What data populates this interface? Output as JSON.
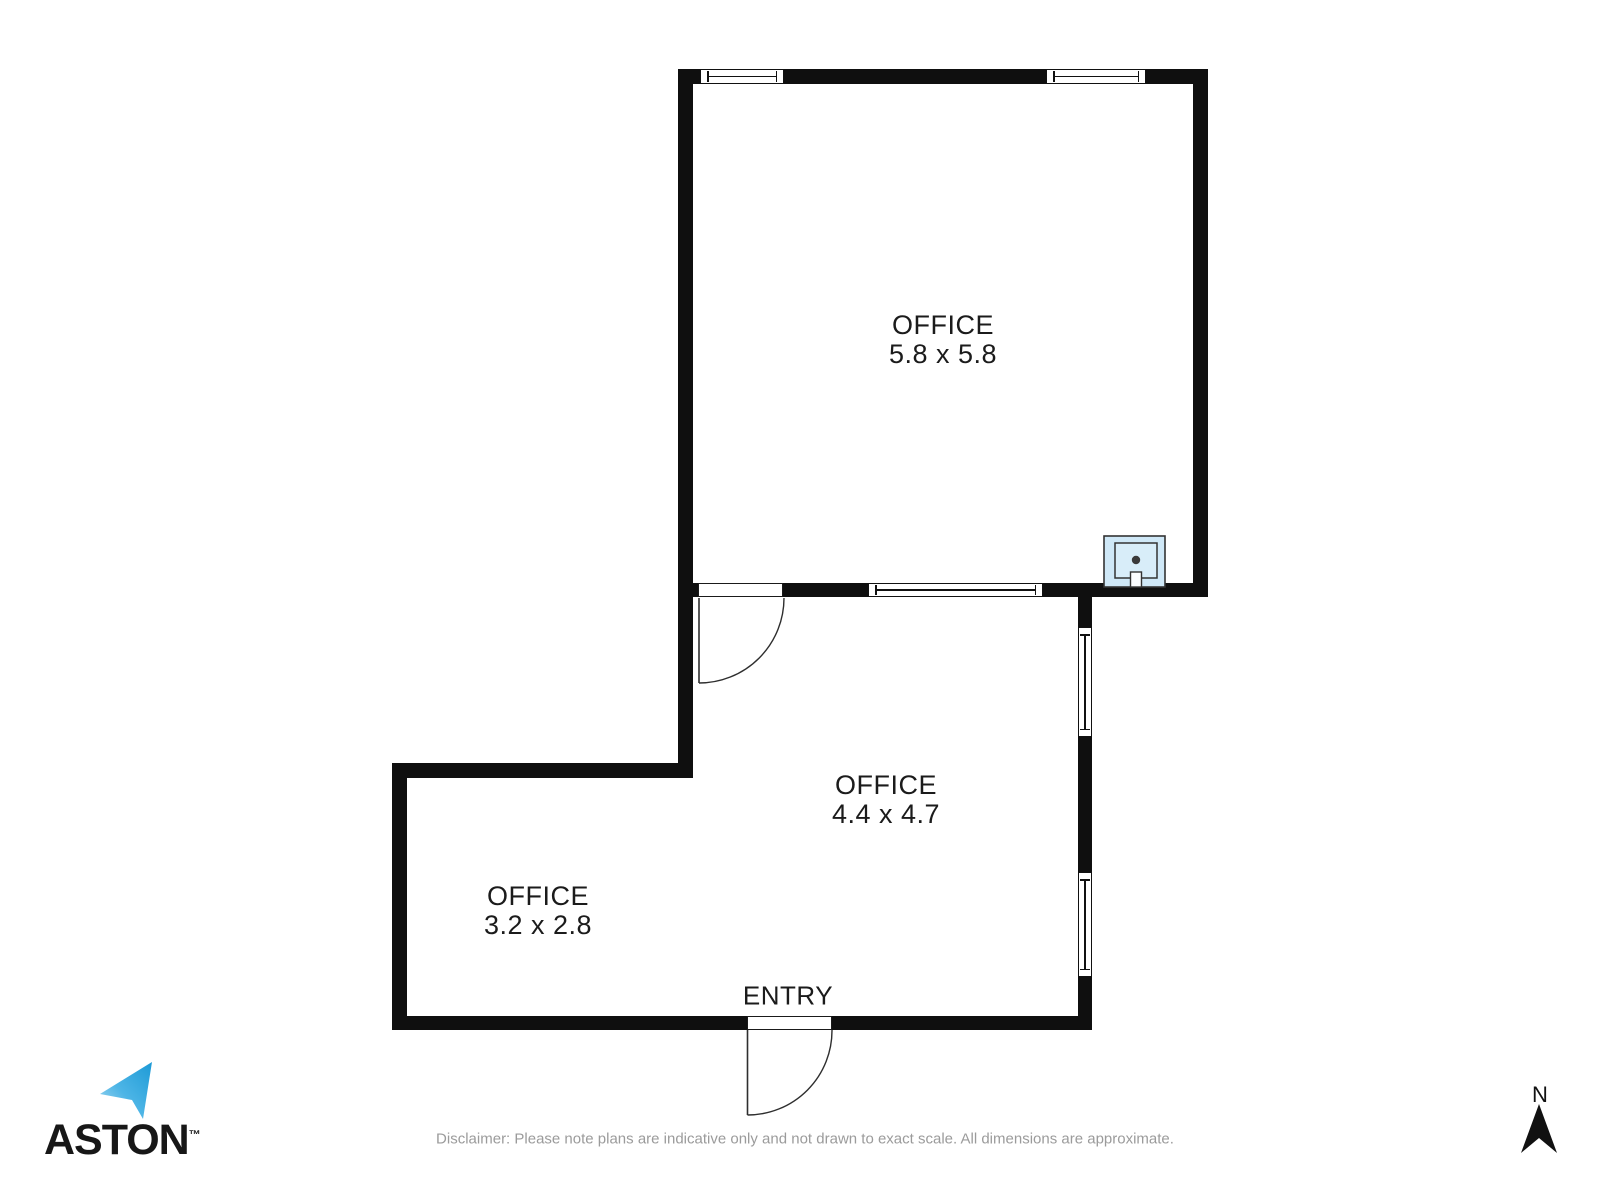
{
  "plan": {
    "rooms": [
      {
        "name": "OFFICE",
        "dims": "5.8 x 5.8"
      },
      {
        "name": "OFFICE",
        "dims": "4.4 x 4.7"
      },
      {
        "name": "OFFICE",
        "dims": "3.2 x 2.8"
      }
    ],
    "entry_label": "ENTRY",
    "fixtures": [
      "sink"
    ]
  },
  "compass": {
    "label": "N"
  },
  "logo": {
    "brand": "ASTON",
    "tm": "™"
  },
  "disclaimer": "Disclaimer: Please note plans are indicative only and not drawn to exact scale. All dimensions are approximate.",
  "colors": {
    "wall": "#0f0f0f",
    "label_text": "#1b1b1b",
    "fixture_blue": "#cfe8f7",
    "logo_blue": "#1d9ad6",
    "logo_blue_light": "#aedcf2",
    "disclaimer_gray": "#9b9b9b"
  }
}
